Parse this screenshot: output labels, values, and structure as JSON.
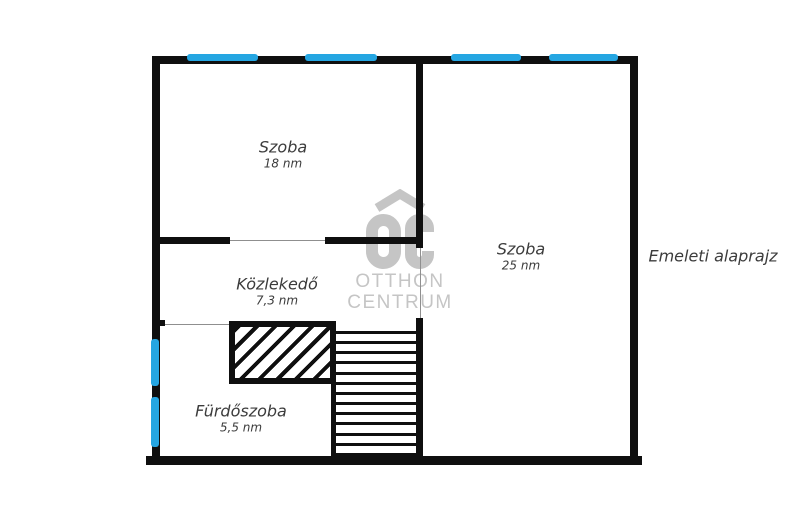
{
  "plan_title": "Emeleti alaprajz",
  "rooms": [
    {
      "name": "Szoba",
      "area": "18 nm"
    },
    {
      "name": "Szoba",
      "area": "25 nm"
    },
    {
      "name": "Közlekedő",
      "area": "7,3 nm"
    },
    {
      "name": "Fürdőszoba",
      "area": "5,5 nm"
    }
  ],
  "watermark": {
    "line1": "OTTHON",
    "line2": "CENTRUM"
  },
  "stairs": {
    "tread_count": 13
  },
  "colors": {
    "wall": "#0f0f0f",
    "window_blue": "#25a6e2",
    "watermark_gray": "#c5c5c5",
    "label_text": "#3c3c3c",
    "thin_line": "#8f8f8f"
  }
}
